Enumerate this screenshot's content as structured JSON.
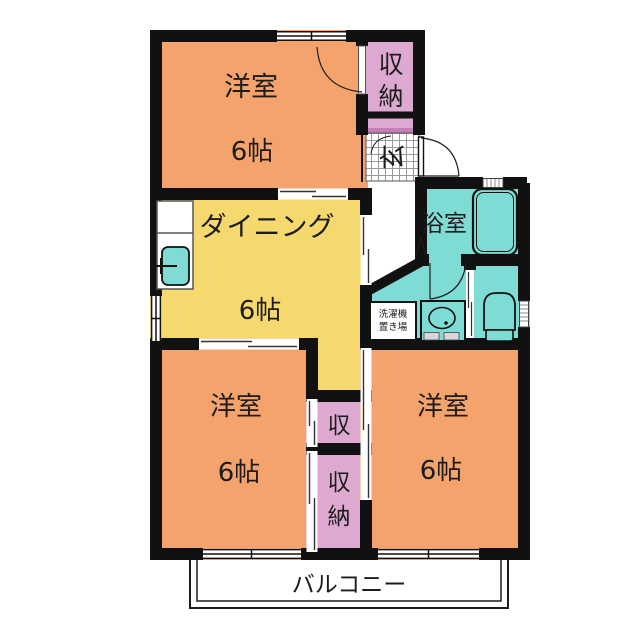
{
  "plan": {
    "type": "apartment-floor-plan",
    "rooms": {
      "bedroom_top": {
        "name": "洋室",
        "size": "6帖"
      },
      "bedroom_left": {
        "name": "洋室",
        "size": "6帖"
      },
      "bedroom_right": {
        "name": "洋室",
        "size": "6帖"
      },
      "dining": {
        "name": "ダイニング",
        "size": "6帖"
      },
      "bathroom": {
        "name": "浴室"
      },
      "closet_top": {
        "chars": [
          "収",
          "納"
        ]
      },
      "closet_mid": {
        "chars": [
          "収"
        ]
      },
      "closet_bottom": {
        "chars": [
          "収",
          "納"
        ]
      },
      "entrance": {
        "label": "玄"
      },
      "laundry": {
        "line1": "洗濯機",
        "line2": "置き場"
      },
      "balcony": {
        "label": "バルコニー"
      }
    },
    "colors": {
      "room_orange": "#F4A36C",
      "dining_yellow": "#F6D96E",
      "storage_pink": "#DEA9D1",
      "storage_pink_dark": "#C77FB8",
      "wet_teal": "#7FDCD5",
      "wall": "#111111",
      "thin_line": "#333333",
      "grey_line": "#8A8A8A"
    }
  }
}
